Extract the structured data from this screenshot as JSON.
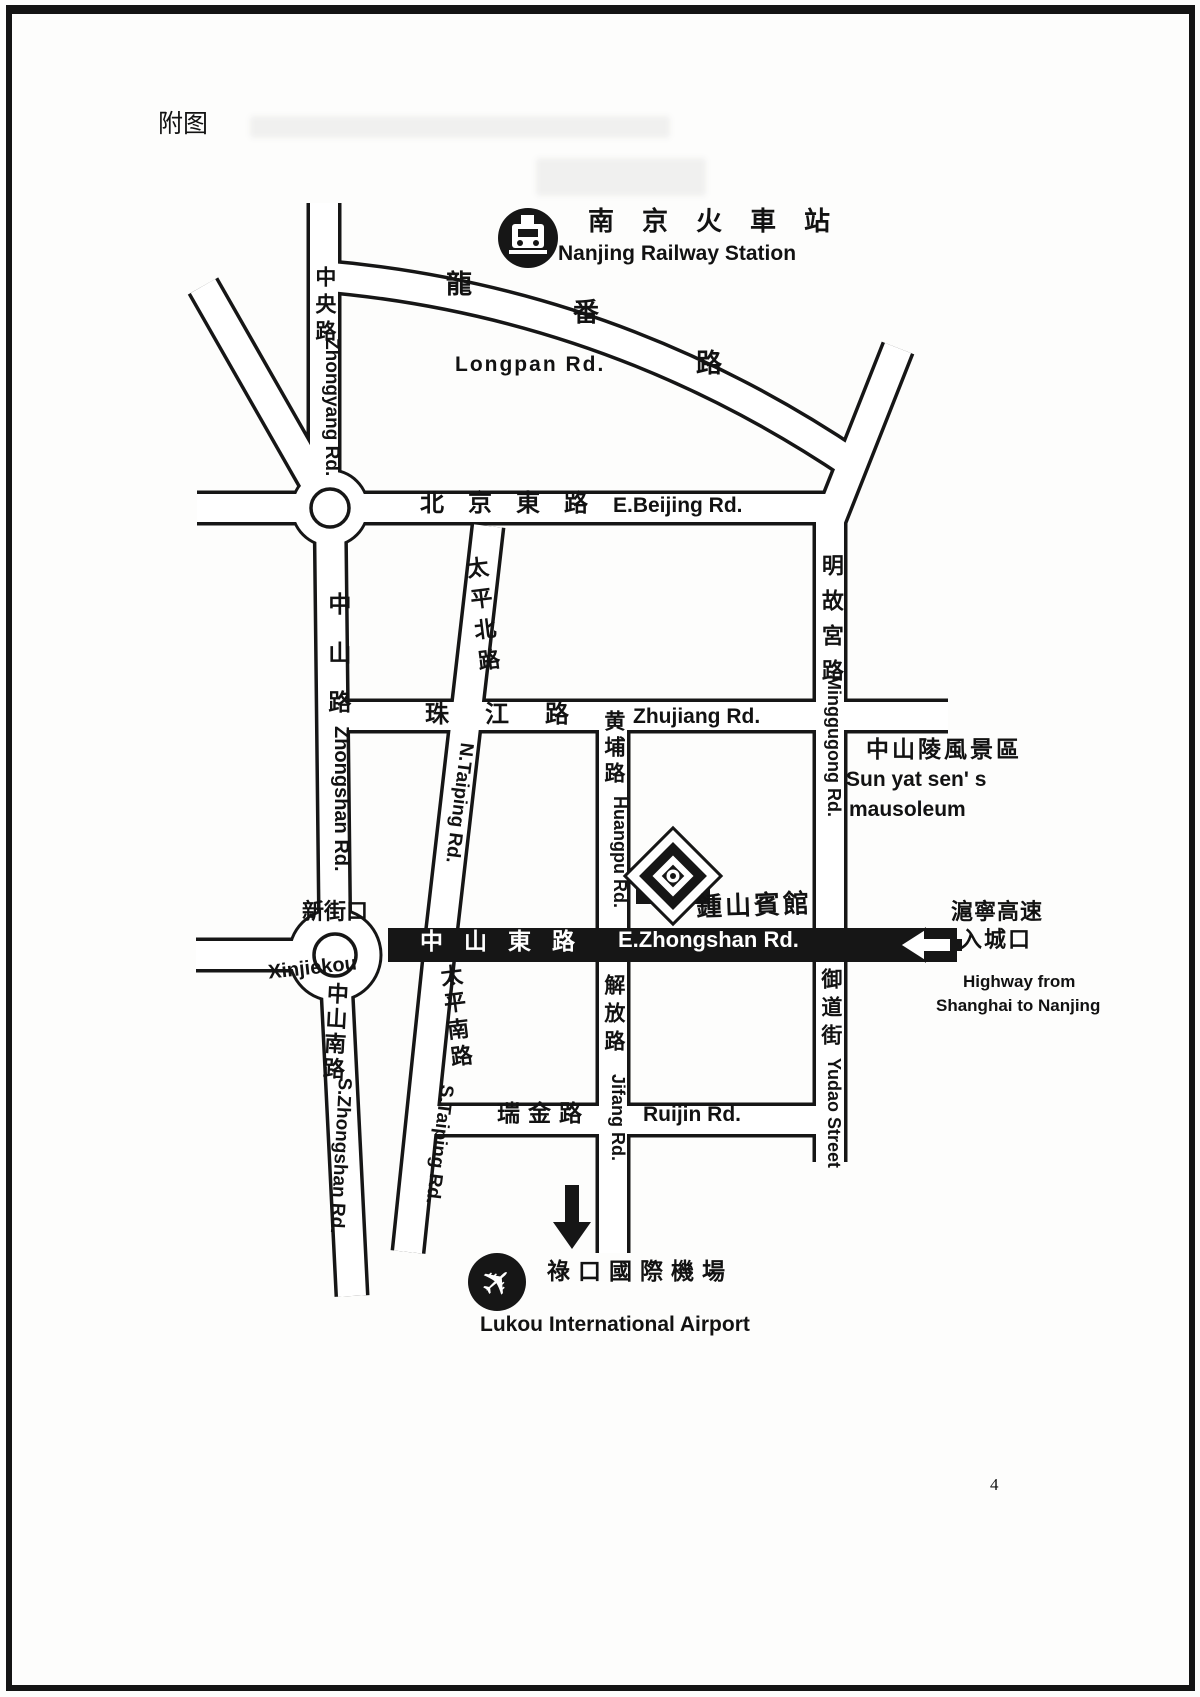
{
  "page": {
    "caption": "附图",
    "page_number": "4"
  },
  "colors": {
    "ink": "#161616",
    "road_fill": "#ffffff",
    "highlight_bar": "#161616"
  },
  "station": {
    "icon": "train-icon",
    "zh": "南京火車站",
    "en": "Nanjing Railway Station"
  },
  "roads": {
    "longpan": {
      "zh_chars": [
        "龍",
        "番",
        "路"
      ],
      "en": "Longpan Rd."
    },
    "zhongyang": {
      "zh": "中央路",
      "en": "Zhongyang Rd."
    },
    "beijing_east": {
      "zh": "北京東路",
      "en": "E.Beijing Rd."
    },
    "taiping_north": {
      "zh": "太平北路",
      "en": "N.Taiping Rd."
    },
    "zhongshan": {
      "zh": "中山路",
      "en": "Zhongshan Rd."
    },
    "zhujiang": {
      "zh": "珠江路",
      "en": "Zhujiang Rd."
    },
    "huangpu": {
      "zh": "黄埔路",
      "en": "Huangpu Rd."
    },
    "minggugong": {
      "zh": "明故宮路",
      "en": "Minggugong Rd."
    },
    "zhongshan_east": {
      "zh": "中山東路",
      "en": "E.Zhongshan Rd."
    },
    "zhongshan_south": {
      "zh": "中山南路",
      "en": "S.Zhongshan Rd."
    },
    "taiping_south": {
      "zh": "太平南路",
      "en": "S.Taiping Rd."
    },
    "jifang": {
      "zh": "解放路",
      "en": "Jifang Rd."
    },
    "ruijin": {
      "zh": "瑞金路",
      "en": "Ruijin Rd."
    },
    "yudao": {
      "zh": "御道街",
      "en": "Yudao Street"
    }
  },
  "places": {
    "xinjiekou": {
      "zh": "新街口",
      "en": "Xinjiekou"
    },
    "hotel": {
      "zh": "鍾山賓館",
      "icon": "hotel-logo"
    },
    "mausoleum": {
      "zh": "中山陵風景區",
      "en_line1": "Sun yat sen' s",
      "en_line2": "mausoleum"
    },
    "highway_entrance": {
      "zh_line1": "滬寧高速",
      "zh_line2": "入城口",
      "en_line1": "Highway from",
      "en_line2": "Shanghai to Nanjing",
      "icon": "left-arrow"
    },
    "airport": {
      "zh": "祿口國際機場",
      "en": "Lukou International Airport",
      "icon": "airplane-icon"
    }
  }
}
